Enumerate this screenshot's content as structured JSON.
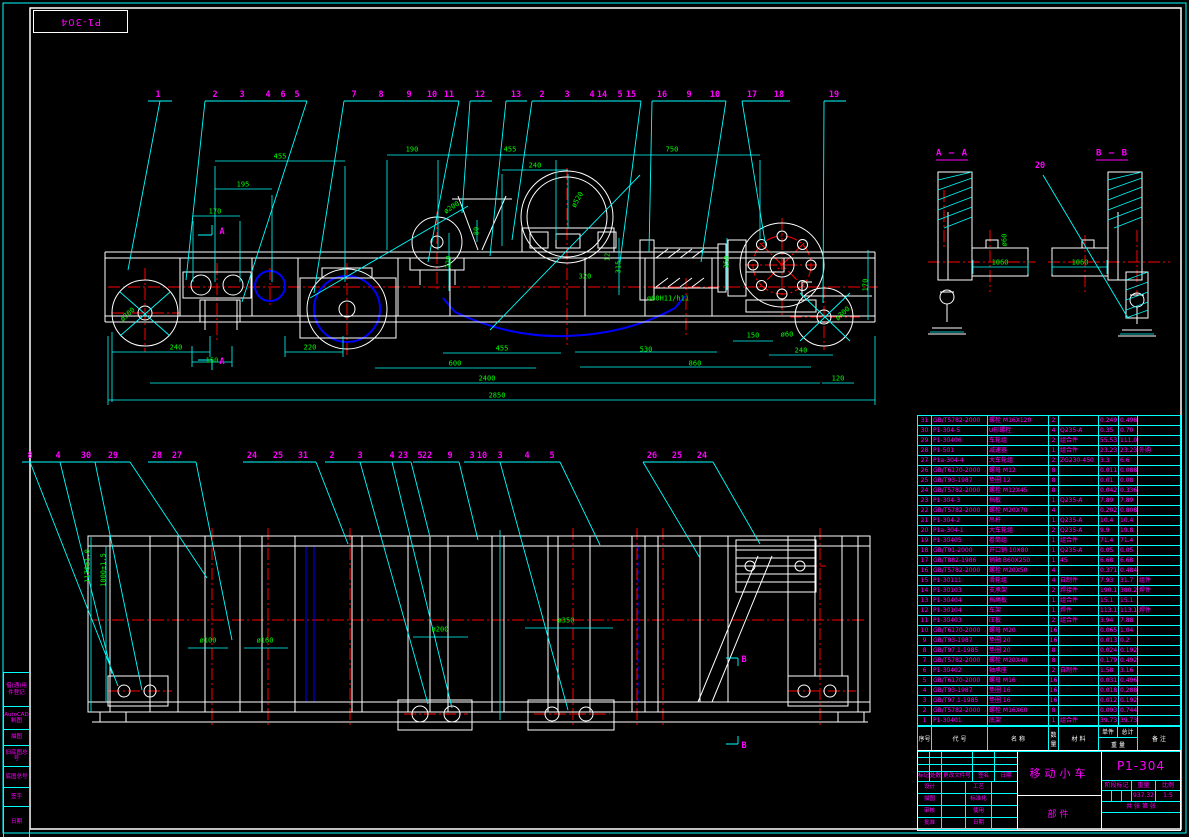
{
  "frame": {
    "corner_stamp": "P1-304"
  },
  "margin_labels": [
    "借(通)用件登记",
    "AutoCAD制图",
    "描图",
    "旧底图总号",
    "底图总号",
    "签字",
    "日期"
  ],
  "top_balloons": [
    {
      "n": "1",
      "x": 158
    },
    {
      "n": "2",
      "x": 215
    },
    {
      "n": "3",
      "x": 242
    },
    {
      "n": "4",
      "x": 268
    },
    {
      "n": "6",
      "x": 283
    },
    {
      "n": "5",
      "x": 297
    },
    {
      "n": "7",
      "x": 354
    },
    {
      "n": "8",
      "x": 381
    },
    {
      "n": "9",
      "x": 409
    },
    {
      "n": "10",
      "x": 432
    },
    {
      "n": "11",
      "x": 449
    },
    {
      "n": "12",
      "x": 480
    },
    {
      "n": "13",
      "x": 516
    },
    {
      "n": "2",
      "x": 542
    },
    {
      "n": "3",
      "x": 567
    },
    {
      "n": "4",
      "x": 592
    },
    {
      "n": "14",
      "x": 602
    },
    {
      "n": "5",
      "x": 620
    },
    {
      "n": "15",
      "x": 631
    },
    {
      "n": "16",
      "x": 662
    },
    {
      "n": "9",
      "x": 689
    },
    {
      "n": "10",
      "x": 715
    },
    {
      "n": "17",
      "x": 752
    },
    {
      "n": "18",
      "x": 779
    },
    {
      "n": "19",
      "x": 834
    }
  ],
  "bottom_balloons": [
    {
      "n": "8",
      "x": 30
    },
    {
      "n": "4",
      "x": 58
    },
    {
      "n": "30",
      "x": 86
    },
    {
      "n": "29",
      "x": 113
    },
    {
      "n": "28",
      "x": 157
    },
    {
      "n": "27",
      "x": 177
    },
    {
      "n": "24",
      "x": 252
    },
    {
      "n": "25",
      "x": 278
    },
    {
      "n": "31",
      "x": 303
    },
    {
      "n": "2",
      "x": 332
    },
    {
      "n": "3",
      "x": 360
    },
    {
      "n": "4",
      "x": 392
    },
    {
      "n": "23",
      "x": 403
    },
    {
      "n": "5",
      "x": 420
    },
    {
      "n": "22",
      "x": 427
    },
    {
      "n": "9",
      "x": 450
    },
    {
      "n": "3",
      "x": 472
    },
    {
      "n": "10",
      "x": 482
    },
    {
      "n": "3",
      "x": 500
    },
    {
      "n": "4",
      "x": 527
    },
    {
      "n": "5",
      "x": 552
    },
    {
      "n": "26",
      "x": 652
    },
    {
      "n": "25",
      "x": 677
    },
    {
      "n": "24",
      "x": 702
    }
  ],
  "section_labels": [
    {
      "t": "A — A",
      "x": 952,
      "y": 155
    },
    {
      "t": "B — B",
      "x": 1112,
      "y": 155
    }
  ],
  "view_markers": [
    {
      "t": "A",
      "x": 222,
      "y": 232
    },
    {
      "t": "A",
      "x": 222,
      "y": 362
    },
    {
      "t": "B",
      "x": 744,
      "y": 660
    },
    {
      "t": "B",
      "x": 744,
      "y": 746
    },
    {
      "t": "20",
      "x": 1040,
      "y": 166
    }
  ],
  "dims": [
    {
      "t": "455",
      "x": 280,
      "y": 157
    },
    {
      "t": "195",
      "x": 243,
      "y": 185
    },
    {
      "t": "170",
      "x": 215,
      "y": 212
    },
    {
      "t": "190",
      "x": 412,
      "y": 150
    },
    {
      "t": "455",
      "x": 510,
      "y": 150
    },
    {
      "t": "750",
      "x": 672,
      "y": 150
    },
    {
      "t": "240",
      "x": 535,
      "y": 166
    },
    {
      "t": "ø200",
      "x": 452,
      "y": 208,
      "r": -33
    },
    {
      "t": "ø520",
      "x": 578,
      "y": 200,
      "r": -60
    },
    {
      "t": "80",
      "x": 477,
      "y": 231,
      "r": -90
    },
    {
      "t": "220",
      "x": 449,
      "y": 262,
      "r": -90
    },
    {
      "t": "320",
      "x": 585,
      "y": 277
    },
    {
      "t": "12",
      "x": 608,
      "y": 257,
      "r": -90
    },
    {
      "t": "315",
      "x": 619,
      "y": 267,
      "r": -90
    },
    {
      "t": "350",
      "x": 727,
      "y": 262,
      "r": -90
    },
    {
      "t": "ø60H11/h11",
      "x": 668,
      "y": 299
    },
    {
      "t": "150",
      "x": 753,
      "y": 336
    },
    {
      "t": "ø60",
      "x": 787,
      "y": 335
    },
    {
      "t": "240",
      "x": 801,
      "y": 351
    },
    {
      "t": "530",
      "x": 646,
      "y": 350
    },
    {
      "t": "860",
      "x": 695,
      "y": 364
    },
    {
      "t": "120",
      "x": 838,
      "y": 379
    },
    {
      "t": "170",
      "x": 866,
      "y": 285,
      "r": -90
    },
    {
      "t": "ø300",
      "x": 843,
      "y": 314,
      "r": -42
    },
    {
      "t": "ø300",
      "x": 128,
      "y": 315,
      "r": -42
    },
    {
      "t": "240",
      "x": 176,
      "y": 348
    },
    {
      "t": "150",
      "x": 212,
      "y": 361
    },
    {
      "t": "220",
      "x": 310,
      "y": 348
    },
    {
      "t": "455",
      "x": 502,
      "y": 349
    },
    {
      "t": "600",
      "x": 455,
      "y": 364
    },
    {
      "t": "2400",
      "x": 487,
      "y": 379
    },
    {
      "t": "2850",
      "x": 497,
      "y": 396
    },
    {
      "t": "1060",
      "x": 1000,
      "y": 263
    },
    {
      "t": "ø60",
      "x": 1005,
      "y": 240,
      "r": -90
    },
    {
      "t": "1060",
      "x": 1080,
      "y": 263
    },
    {
      "t": "ø100",
      "x": 208,
      "y": 641
    },
    {
      "t": "ø160",
      "x": 265,
      "y": 641
    },
    {
      "t": "ø200",
      "x": 440,
      "y": 630
    },
    {
      "t": "ø350",
      "x": 566,
      "y": 621
    },
    {
      "t": "1170±1.0",
      "x": 88,
      "y": 566,
      "r": -90
    },
    {
      "t": "1000±1.5",
      "x": 104,
      "y": 570,
      "r": -90
    }
  ],
  "bom": {
    "headers": {
      "no": "序号",
      "code": "代 号",
      "name": "名 称",
      "qty": "数量",
      "mat": "材 料",
      "unit": "单件",
      "total": "总计",
      "weight": "重 量",
      "remark": "备 注"
    },
    "rows": [
      {
        "no": "31",
        "code": "GB/T5782-2000",
        "name": "螺栓 M16X120",
        "qty": "2",
        "mat": "",
        "unit": "0.249",
        "total": "0.498",
        "rk": ""
      },
      {
        "no": "30",
        "code": "P1-304-5",
        "name": "U形螺栓",
        "qty": "4",
        "mat": "Q235-A",
        "unit": "0.35",
        "total": "0.70",
        "rk": ""
      },
      {
        "no": "29",
        "code": "P1-30406",
        "name": "车轮组",
        "qty": "2",
        "mat": "组合件",
        "unit": "55.53",
        "total": "111.06",
        "rk": ""
      },
      {
        "no": "28",
        "code": "P1-501",
        "name": "减速器",
        "qty": "1",
        "mat": "组合件",
        "unit": "23.23",
        "total": "23.23",
        "rk": "外购"
      },
      {
        "no": "27",
        "code": "P1a-304-4",
        "name": "大车轮组",
        "qty": "2",
        "mat": "ZG230-450",
        "unit": "3.3",
        "total": "6.6",
        "rk": ""
      },
      {
        "no": "26",
        "code": "GB/T6170-2000",
        "name": "螺母 M12",
        "qty": "8",
        "mat": "",
        "unit": "0.011",
        "total": "0.088",
        "rk": ""
      },
      {
        "no": "25",
        "code": "GB/T93-1987",
        "name": "垫圈 12",
        "qty": "8",
        "mat": "",
        "unit": "0.01",
        "total": "0.08",
        "rk": ""
      },
      {
        "no": "24",
        "code": "GB/T5782-2000",
        "name": "螺栓 M12X45",
        "qty": "8",
        "mat": "",
        "unit": "0.042",
        "total": "0.336",
        "rk": ""
      },
      {
        "no": "23",
        "code": "P1-304-3",
        "name": "挡板",
        "qty": "1",
        "mat": "Q235-A",
        "unit": "7.89",
        "total": "7.89",
        "rk": ""
      },
      {
        "no": "22",
        "code": "GB/T5782-2000",
        "name": "螺栓 M20X70",
        "qty": "4",
        "mat": "",
        "unit": "0.202",
        "total": "0.808",
        "rk": ""
      },
      {
        "no": "21",
        "code": "P1-304-2",
        "name": "吊杆",
        "qty": "1",
        "mat": "Q235-A",
        "unit": "10.4",
        "total": "10.4",
        "rk": ""
      },
      {
        "no": "20",
        "code": "P1a-304-1",
        "name": "大车轮组",
        "qty": "2",
        "mat": "Q235-A",
        "unit": "9.9",
        "total": "19.8",
        "rk": ""
      },
      {
        "no": "19",
        "code": "P1-30405",
        "name": "卷筒组",
        "qty": "1",
        "mat": "组合件",
        "unit": "71.4",
        "total": "71.4",
        "rk": ""
      },
      {
        "no": "18",
        "code": "GB/T91-2000",
        "name": "开口销 10X80",
        "qty": "1",
        "mat": "Q235-A",
        "unit": "0.05",
        "total": "0.05",
        "rk": ""
      },
      {
        "no": "17",
        "code": "GB/T882-1986",
        "name": "销轴 B60X250",
        "qty": "1",
        "mat": "45",
        "unit": "6.68",
        "total": "6.68",
        "rk": ""
      },
      {
        "no": "16",
        "code": "GB/T5782-2000",
        "name": "螺栓 M20X50",
        "qty": "4",
        "mat": "",
        "unit": "0.371",
        "total": "0.484",
        "rk": ""
      },
      {
        "no": "15",
        "code": "P1-30111",
        "name": "滑轮组",
        "qty": "4",
        "mat": "自制件",
        "unit": "7.93",
        "total": "31.7",
        "rk": "组件"
      },
      {
        "no": "14",
        "code": "P1-30103",
        "name": "支承架",
        "qty": "2",
        "mat": "焊接件",
        "unit": "190.1",
        "total": "380.2",
        "rk": "焊件"
      },
      {
        "no": "13",
        "code": "P1-30404",
        "name": "挡绳板",
        "qty": "1",
        "mat": "组合件",
        "unit": "15.1",
        "total": "15.1",
        "rk": ""
      },
      {
        "no": "12",
        "code": "P1-30104",
        "name": "车架",
        "qty": "1",
        "mat": "焊件",
        "unit": "113.15",
        "total": "113.15",
        "rk": "焊件"
      },
      {
        "no": "11",
        "code": "P1-30403",
        "name": "压板",
        "qty": "2",
        "mat": "组合件",
        "unit": "3.94",
        "total": "7.88",
        "rk": ""
      },
      {
        "no": "10",
        "code": "GB/T6170-2000",
        "name": "螺母 M20",
        "qty": "16",
        "mat": "",
        "unit": "0.065",
        "total": "1.04",
        "rk": ""
      },
      {
        "no": "9",
        "code": "GB/T93-1987",
        "name": "垫圈 20",
        "qty": "16",
        "mat": "",
        "unit": "0.013",
        "total": "0.2",
        "rk": ""
      },
      {
        "no": "8",
        "code": "GB/T97.1-1985",
        "name": "垫圈 20",
        "qty": "8",
        "mat": "",
        "unit": "0.024",
        "total": "0.192",
        "rk": ""
      },
      {
        "no": "7",
        "code": "GB/T5782-2000",
        "name": "螺栓 M20X40",
        "qty": "8",
        "mat": "",
        "unit": "0.179",
        "total": "0.492",
        "rk": ""
      },
      {
        "no": "6",
        "code": "P1-30402",
        "name": "轴承座",
        "qty": "2",
        "mat": "自制件",
        "unit": "1.58",
        "total": "3.16",
        "rk": ""
      },
      {
        "no": "5",
        "code": "GB/T6170-2000",
        "name": "螺母 M16",
        "qty": "16",
        "mat": "",
        "unit": "0.031",
        "total": "0.496",
        "rk": ""
      },
      {
        "no": "4",
        "code": "GB/T93-1987",
        "name": "垫圈 16",
        "qty": "16",
        "mat": "",
        "unit": "0.018",
        "total": "0.288",
        "rk": ""
      },
      {
        "no": "3",
        "code": "GB/T97.1-1985",
        "name": "垫圈 16",
        "qty": "16",
        "mat": "",
        "unit": "0.012",
        "total": "0.192",
        "rk": ""
      },
      {
        "no": "2",
        "code": "GB/T5782-2000",
        "name": "螺栓 M16X60",
        "qty": "8",
        "mat": "",
        "unit": "0.093",
        "total": "0.744",
        "rk": ""
      },
      {
        "no": "1",
        "code": "P1-30401",
        "name": "底架",
        "qty": "1",
        "mat": "组合件",
        "unit": "39.73",
        "total": "39.73",
        "rk": ""
      }
    ]
  },
  "title_block": {
    "title": "移动小车",
    "subtitle": "部件",
    "drawing_no": "P1-304",
    "stage_label": "阶段标记",
    "weight_label": "重量",
    "scale_label": "比例",
    "weight": "937.32",
    "scale": "1:5",
    "sheet_label": "共 张 第 张",
    "rev_headers": [
      "标记",
      "处数",
      "更改文件号",
      "签名",
      "日期"
    ],
    "sig_rows": [
      [
        "设计",
        "工艺"
      ],
      [
        "描图",
        "标准化"
      ],
      [
        "审核",
        "使用"
      ],
      [
        "批准",
        "日期"
      ]
    ]
  },
  "colors": {
    "geometry": "#ffffff",
    "annotation": "#00ffff",
    "dimension_text": "#00ff00",
    "callout_text": "#ff00ff",
    "centerline": "#ff0000",
    "rope": "#0000ff",
    "background": "#000000"
  }
}
